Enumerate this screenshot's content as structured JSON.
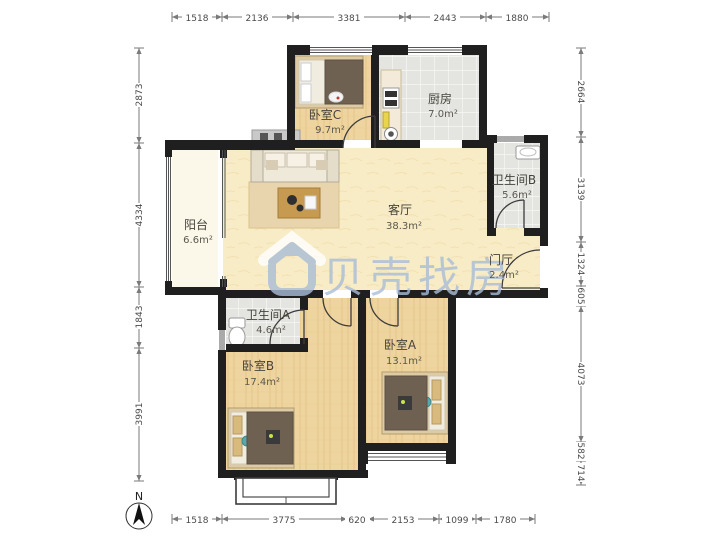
{
  "watermark": {
    "brand": "贝壳找房",
    "color": "#a9bdd8"
  },
  "compass": {
    "north": "N"
  },
  "rooms": {
    "bedroom_c": {
      "label": "卧室C",
      "area": "9.7m²"
    },
    "kitchen": {
      "label": "厨房",
      "area": "7.0m²"
    },
    "balcony": {
      "label": "阳台",
      "area": "6.6m²"
    },
    "living": {
      "label": "客厅",
      "area": "38.3m²"
    },
    "bathroom_b": {
      "label": "卫生间B",
      "area": "5.6m²"
    },
    "foyer": {
      "label": "门厅",
      "area": "2.4m²"
    },
    "bathroom_a": {
      "label": "卫生间A",
      "area": "4.6m²"
    },
    "bedroom_b": {
      "label": "卧室B",
      "area": "17.4m²"
    },
    "bedroom_a": {
      "label": "卧室A",
      "area": "13.1m²"
    }
  },
  "dims": {
    "top": [
      "1518",
      "2136",
      "3381",
      "2443",
      "1880"
    ],
    "bottom": [
      "1518",
      "3775",
      "620",
      "2153",
      "1099",
      "1780"
    ],
    "left": [
      "2873",
      "4334",
      "1843",
      "3991"
    ],
    "right": [
      "2664",
      "3139",
      "1324",
      "605",
      "4073",
      "582",
      "714"
    ]
  },
  "palette": {
    "wall": "#1f1f1f",
    "wood_floor": "#eed49e",
    "tile_floor": "#e4e4e1",
    "living_floor": "#f8ecc6",
    "balcony_floor": "#fbf8e9",
    "rug": "#e8d5ad",
    "bed_blanket": "#6f6152",
    "accent_teal": "#57a8ad"
  }
}
